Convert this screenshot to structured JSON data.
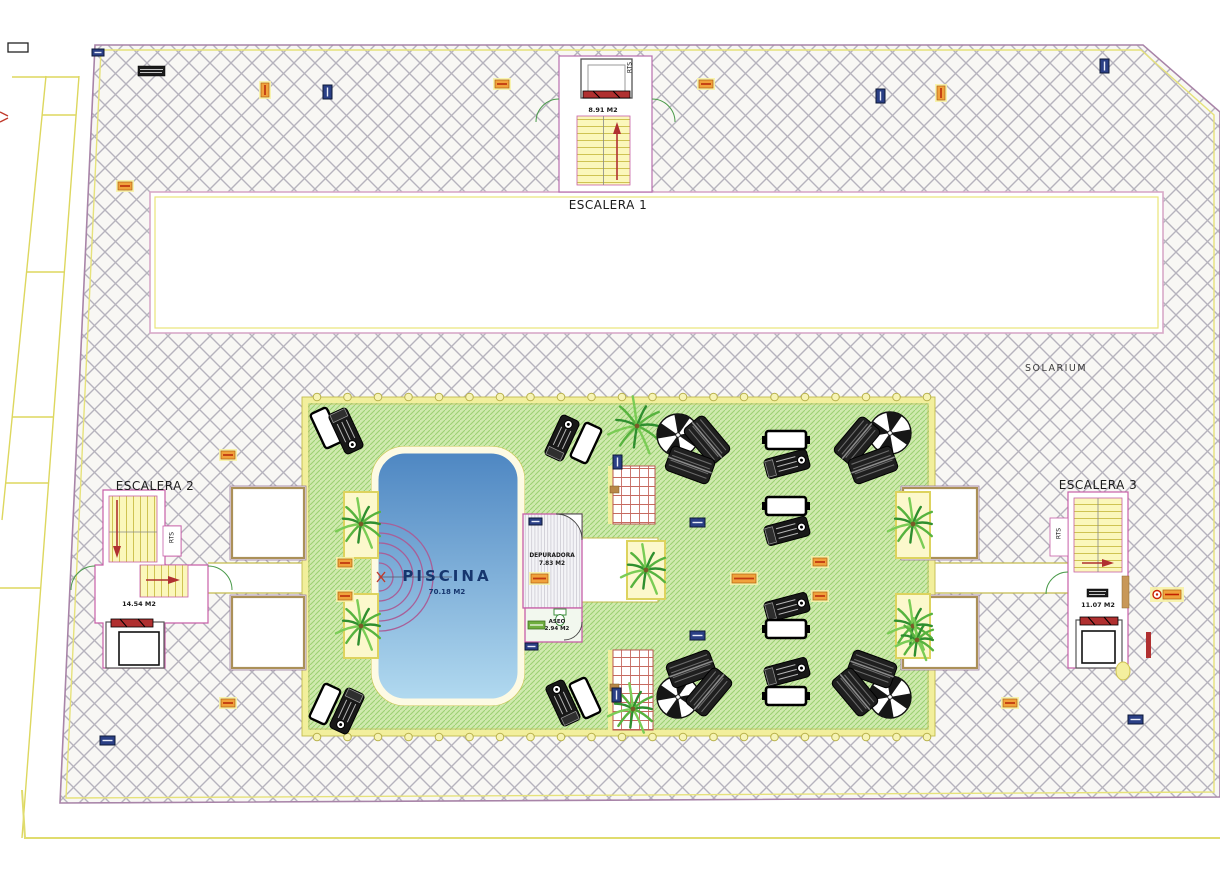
{
  "plan": {
    "labels": {
      "escalera1": "ESCALERA 1",
      "escalera1_area": "8.91 M2",
      "escalera2": "ESCALERA 2",
      "escalera2_area": "14.54 M2",
      "escalera3": "ESCALERA 3",
      "escalera3_area": "11.07 M2",
      "rts": "RTS",
      "piscina": "PISCINA",
      "piscina_area": "70.18 M2",
      "depuradora": "DEPURADORA",
      "depuradora_area": "7.83 M2",
      "aseo": "ASEO",
      "aseo_area": "2.94 M2",
      "solarium": "SOLARIUM"
    },
    "colors": {
      "hatch_line": "#b6b3bd",
      "lawn_green": "#cfeaae",
      "lawn_hatch_line": "#9bd072",
      "pool_top": "#4d86c2",
      "pool_bottom": "#b2daf0",
      "border_yellow": "#f2ef9c",
      "boundary_purple": "#a884a8",
      "room_outline_magenta": "#c75fa8",
      "stair_yellow": "#fbf7bb",
      "marker_red": "#b03030",
      "tag_orange": "#f0a23c",
      "tag_navy": "#2a3f85",
      "door_green": "#4a9a4a"
    },
    "furniture": {
      "umbrellas": [
        {
          "x": 678,
          "y": 435
        },
        {
          "x": 890,
          "y": 433
        },
        {
          "x": 678,
          "y": 697
        },
        {
          "x": 890,
          "y": 697
        }
      ],
      "lounger_stacks": [
        {
          "x": 707,
          "y": 440,
          "r": 50
        },
        {
          "x": 690,
          "y": 465,
          "r": 20
        },
        {
          "x": 857,
          "y": 441,
          "r": -50
        },
        {
          "x": 873,
          "y": 465,
          "r": -20
        },
        {
          "x": 691,
          "y": 669,
          "r": -20
        },
        {
          "x": 709,
          "y": 692,
          "r": -50
        },
        {
          "x": 872,
          "y": 669,
          "r": 20
        },
        {
          "x": 855,
          "y": 692,
          "r": 50
        }
      ],
      "white_loungers": [
        {
          "x": 326,
          "y": 428,
          "r": 65
        },
        {
          "x": 586,
          "y": 443,
          "r": -65
        },
        {
          "x": 325,
          "y": 704,
          "r": 115
        },
        {
          "x": 585,
          "y": 698,
          "r": -115
        }
      ],
      "wheeled_loungers": [
        {
          "x": 346,
          "y": 431,
          "r": 65
        },
        {
          "x": 562,
          "y": 438,
          "r": -65
        },
        {
          "x": 347,
          "y": 711,
          "r": 115
        },
        {
          "x": 563,
          "y": 703,
          "r": -115
        },
        {
          "x": 787,
          "y": 464,
          "r": -15
        },
        {
          "x": 787,
          "y": 531,
          "r": -15
        },
        {
          "x": 787,
          "y": 607,
          "r": -15
        },
        {
          "x": 787,
          "y": 672,
          "r": -15
        }
      ],
      "tables": [
        {
          "x": 786,
          "y": 440
        },
        {
          "x": 786,
          "y": 506
        },
        {
          "x": 786,
          "y": 629
        },
        {
          "x": 786,
          "y": 696
        }
      ],
      "planters": [
        {
          "x": 344,
          "y": 492,
          "w": 34,
          "h": 66
        },
        {
          "x": 344,
          "y": 594,
          "w": 34,
          "h": 64
        },
        {
          "x": 896,
          "y": 492,
          "w": 34,
          "h": 66
        },
        {
          "x": 896,
          "y": 594,
          "w": 34,
          "h": 64
        },
        {
          "x": 627,
          "y": 541,
          "w": 38,
          "h": 58
        }
      ],
      "palms": [
        {
          "x": 361,
          "y": 524,
          "s": 26
        },
        {
          "x": 361,
          "y": 626,
          "s": 26
        },
        {
          "x": 913,
          "y": 524,
          "s": 26
        },
        {
          "x": 913,
          "y": 626,
          "s": 26
        },
        {
          "x": 637,
          "y": 426,
          "s": 30
        },
        {
          "x": 646,
          "y": 570,
          "s": 26
        },
        {
          "x": 633,
          "y": 709,
          "s": 26
        },
        {
          "x": 917,
          "y": 640,
          "s": 22
        }
      ]
    },
    "tags": [
      {
        "t": "white",
        "x": 8,
        "y": 43,
        "w": 20,
        "h": 9
      },
      {
        "t": "navy-h",
        "x": 92,
        "y": 49,
        "w": 12,
        "h": 7
      },
      {
        "t": "black",
        "x": 138,
        "y": 66,
        "w": 27,
        "h": 10
      },
      {
        "t": "orange-v",
        "x": 261,
        "y": 83
      },
      {
        "t": "navy-v",
        "x": 323,
        "y": 85
      },
      {
        "t": "orange-h",
        "x": 495,
        "y": 80
      },
      {
        "t": "orange-h",
        "x": 699,
        "y": 80
      },
      {
        "t": "navy-v",
        "x": 876,
        "y": 89
      },
      {
        "t": "orange-v",
        "x": 937,
        "y": 86
      },
      {
        "t": "navy-v",
        "x": 1100,
        "y": 59
      },
      {
        "t": "orange-h",
        "x": 118,
        "y": 182
      },
      {
        "t": "orange-h",
        "x": 221,
        "y": 451
      },
      {
        "t": "orange-h",
        "x": 338,
        "y": 559
      },
      {
        "t": "orange-h",
        "x": 338,
        "y": 592
      },
      {
        "t": "orange-h",
        "x": 221,
        "y": 699
      },
      {
        "t": "navy-h",
        "x": 100,
        "y": 736
      },
      {
        "t": "navy-v",
        "x": 613,
        "y": 455
      },
      {
        "t": "navy-v",
        "x": 612,
        "y": 688
      },
      {
        "t": "navy-h",
        "x": 690,
        "y": 518
      },
      {
        "t": "navy-h",
        "x": 690,
        "y": 631
      },
      {
        "t": "orange-h",
        "x": 732,
        "y": 574,
        "w": 24,
        "h": 9
      },
      {
        "t": "orange-h",
        "x": 813,
        "y": 558
      },
      {
        "t": "orange-h",
        "x": 813,
        "y": 592
      },
      {
        "t": "orange-dot",
        "x": 1152,
        "y": 589,
        "w": 30,
        "h": 11
      },
      {
        "t": "navy-h",
        "x": 1128,
        "y": 715
      },
      {
        "t": "orange-h",
        "x": 1003,
        "y": 699
      },
      {
        "t": "black",
        "x": 1087,
        "y": 589,
        "w": 21,
        "h": 8
      },
      {
        "t": "green-h",
        "x": 528,
        "y": 621,
        "w": 17,
        "h": 8
      },
      {
        "t": "navy-h",
        "x": 529,
        "y": 518,
        "w": 13,
        "h": 7
      },
      {
        "t": "navy-h",
        "x": 525,
        "y": 643,
        "w": 13,
        "h": 7
      },
      {
        "t": "orange-h",
        "x": 531,
        "y": 574,
        "w": 17,
        "h": 9
      },
      {
        "t": "red-tick",
        "x": 0,
        "y": 112
      }
    ]
  }
}
